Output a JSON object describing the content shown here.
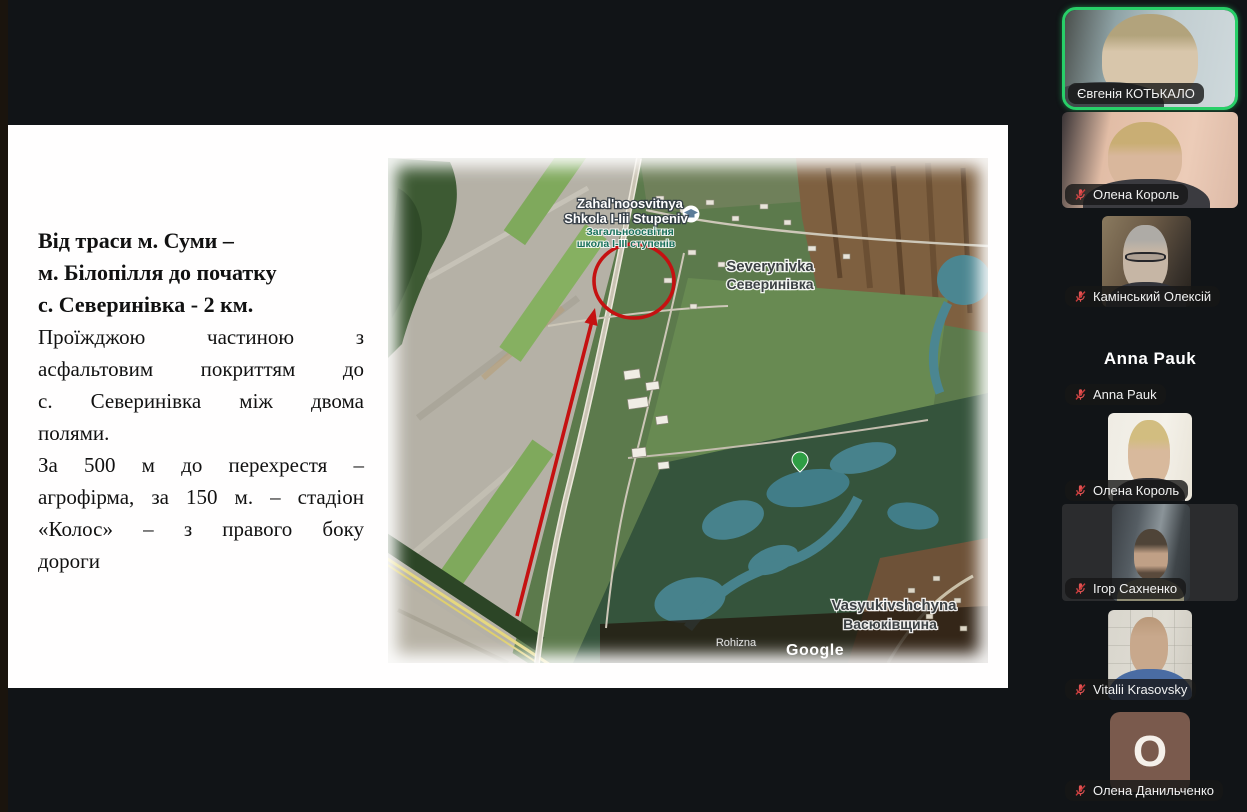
{
  "slide": {
    "lines": [
      "Від траси м. Суми –",
      "м. Білопілля до початку",
      "с. Северинівка - 2 км.",
      "Проїжджою частиною з",
      "асфальтовим покриттям до",
      "с. Северинівка між двома",
      "полями.",
      "За 500 м до перехрестя –",
      "агрофірма, за 150 м. – стадіон",
      "«Колос» – з правого боку",
      "дороги"
    ]
  },
  "map": {
    "labels": {
      "school_latin_1": "Zahal'noosvitnya",
      "school_latin_2": "Shkola I-Iii Stupeniv",
      "school_cyr_1": "Загальноосвітня",
      "school_cyr_2": "школа І-ІІІ ступенів",
      "town_latin": "Severynivka",
      "town_cyr": "Северинівка",
      "village_latin": "Vasyukivshchyna",
      "village_cyr": "Васюківщина",
      "hamlet": "Rohizna",
      "attribution": "Google"
    },
    "annotation_color": "#c51111"
  },
  "participants": [
    {
      "name": "Євгенія КОТЬКАЛО",
      "muted": false,
      "active_speaker": true
    },
    {
      "name": "Олена Король",
      "muted": true
    },
    {
      "name": "Камінський Олексій",
      "muted": true
    },
    {
      "name": "Anna Pauk",
      "muted": true,
      "center_display_name": "Anna Pauk"
    },
    {
      "name": "Олена Король",
      "muted": true
    },
    {
      "name": "Ігор Сахненко",
      "muted": true
    },
    {
      "name": "Vitalii Krasovsky",
      "muted": true
    },
    {
      "name": "Олена Данильченко",
      "muted": true,
      "avatar_letter": "О"
    }
  ],
  "colors": {
    "active_speaker_border": "#28cf68",
    "muted_mic": "#e05252",
    "annotation_red": "#c51111",
    "avatar_bg": "#7a5a4d"
  }
}
